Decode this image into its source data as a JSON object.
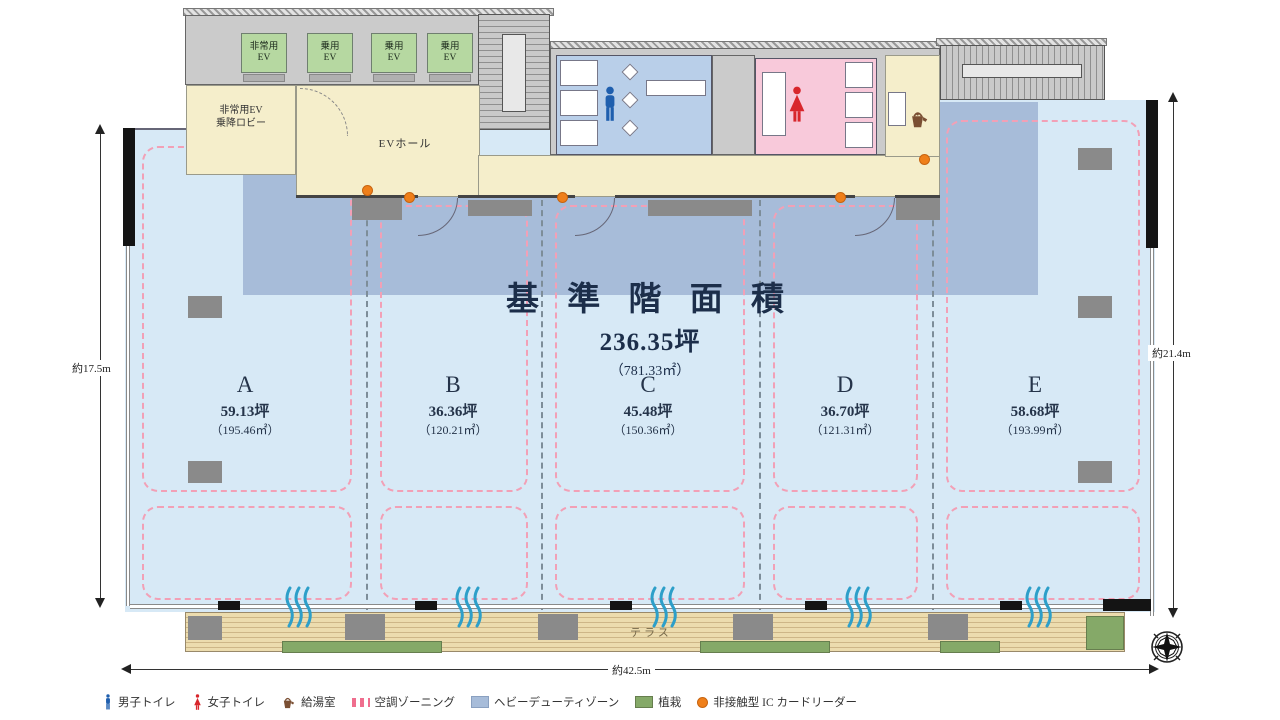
{
  "title": {
    "main": "基 準 階 面 積",
    "tsubo": "236.35坪",
    "sqm": "（781.33㎡）"
  },
  "zones": [
    {
      "label": "A",
      "tsubo": "59.13坪",
      "sqm": "（195.46㎡）"
    },
    {
      "label": "B",
      "tsubo": "36.36坪",
      "sqm": "（120.21㎡）"
    },
    {
      "label": "C",
      "tsubo": "45.48坪",
      "sqm": "（150.36㎡）"
    },
    {
      "label": "D",
      "tsubo": "36.70坪",
      "sqm": "（121.31㎡）"
    },
    {
      "label": "E",
      "tsubo": "58.68坪",
      "sqm": "（193.99㎡）"
    }
  ],
  "core": {
    "ev_emergency": [
      "非常用",
      "EV"
    ],
    "ev_passenger": [
      "乗用",
      "EV"
    ],
    "lobby": [
      "非常用EV",
      "乗降ロビー"
    ],
    "ev_hall": "EVホール"
  },
  "terrace": {
    "label": "テラス"
  },
  "dimensions": {
    "left": "約17.5m",
    "right": "約21.4m",
    "bottom": "約42.5m"
  },
  "legend": [
    {
      "name": "male-toilet",
      "label": "男子トイレ"
    },
    {
      "name": "female-toilet",
      "label": "女子トイレ"
    },
    {
      "name": "kitchenette",
      "label": "給湯室"
    },
    {
      "name": "ac-zoning",
      "label": "空調ゾーニング"
    },
    {
      "name": "heavy-duty-zone",
      "label": "ヘビーデューティゾーン"
    },
    {
      "name": "planting",
      "label": "植栽"
    },
    {
      "name": "ic-card-reader",
      "label": "非接触型 IC カードリーダー"
    }
  ],
  "colors": {
    "floor": "#d7e9f6",
    "heavy_duty": "#a7bcd9",
    "core_gray": "#cbcbcb",
    "ev_hall_yellow": "#f5eecb",
    "elevator_green": "#b6d8a1",
    "mens_blue": "#b9cfe9",
    "womens_pink": "#f8c9da",
    "deck_wood": "#e9d8ab",
    "planting_green": "#85a968",
    "ic_orange": "#ef7f1a",
    "zoning_pink": "#f2a0b6",
    "male_icon": "#1f5fae",
    "female_icon": "#d8262c"
  }
}
